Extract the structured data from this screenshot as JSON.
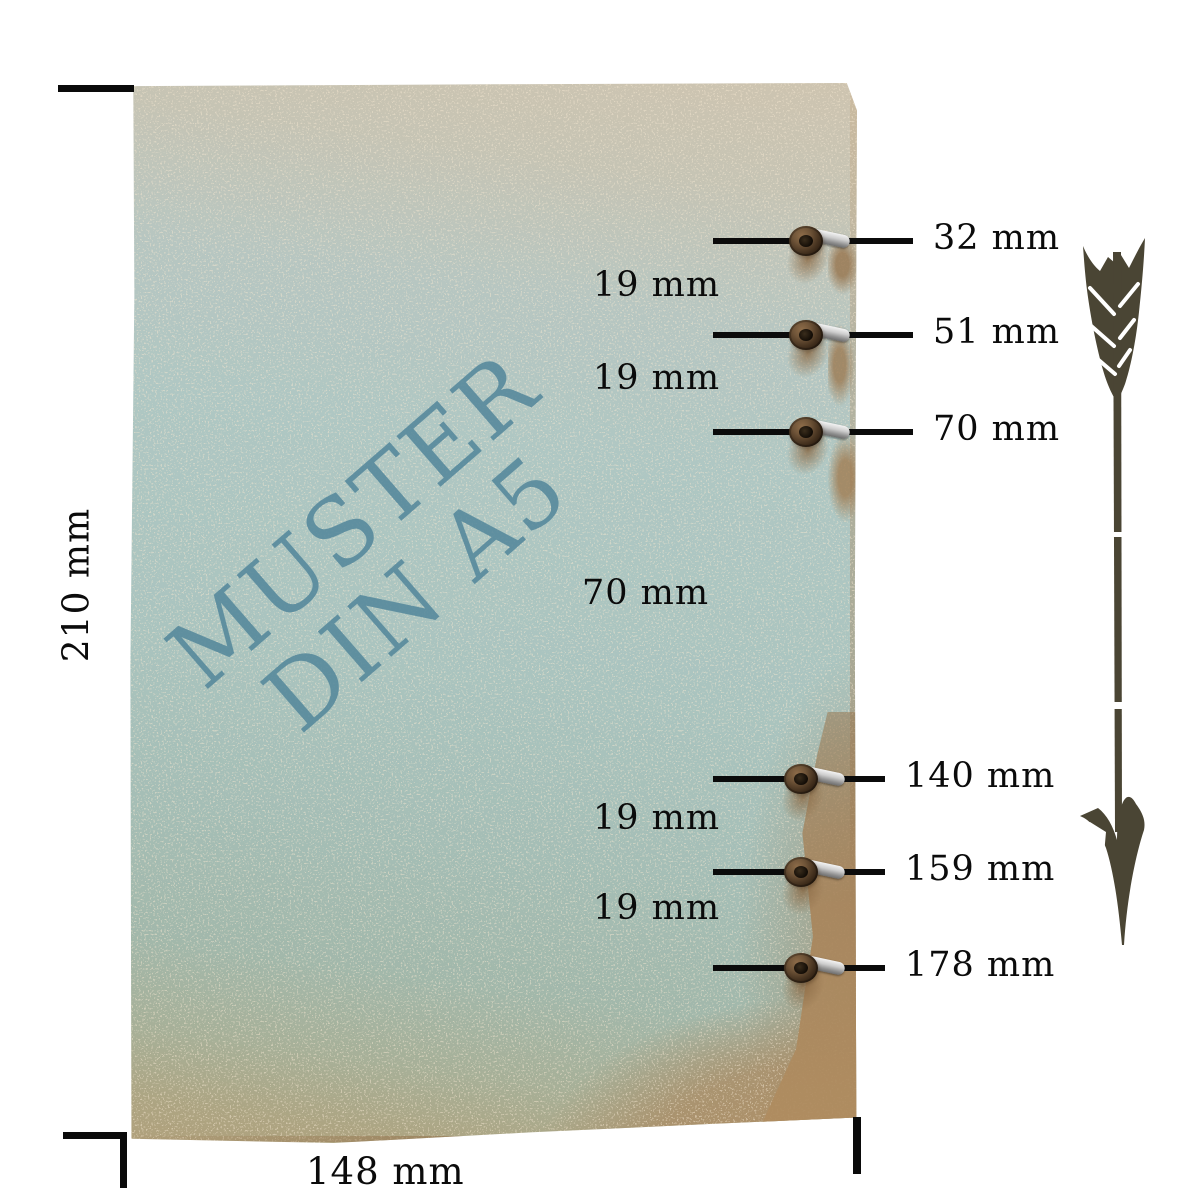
{
  "watermark": {
    "line1": "MUSTER",
    "line2": "DIN A5"
  },
  "sheet": {
    "width_label": "148 mm",
    "height_label": "210 mm"
  },
  "holes": [
    {
      "label": "32 mm"
    },
    {
      "label": "51 mm"
    },
    {
      "label": "70 mm"
    },
    {
      "label": "140 mm"
    },
    {
      "label": "159 mm"
    },
    {
      "label": "178 mm"
    }
  ],
  "gaps": [
    {
      "label": "19 mm"
    },
    {
      "label": "19 mm"
    },
    {
      "label": "70 mm"
    },
    {
      "label": "19 mm"
    },
    {
      "label": "19 mm"
    }
  ],
  "colors": {
    "watermark_teal": "#54879b",
    "arrow_olive": "#4a4534",
    "label_black": "#0b0b0b",
    "paper_teal": "#aac4bf",
    "paper_beige": "#cec4b0",
    "cardboard_brown": "#a8855c"
  }
}
